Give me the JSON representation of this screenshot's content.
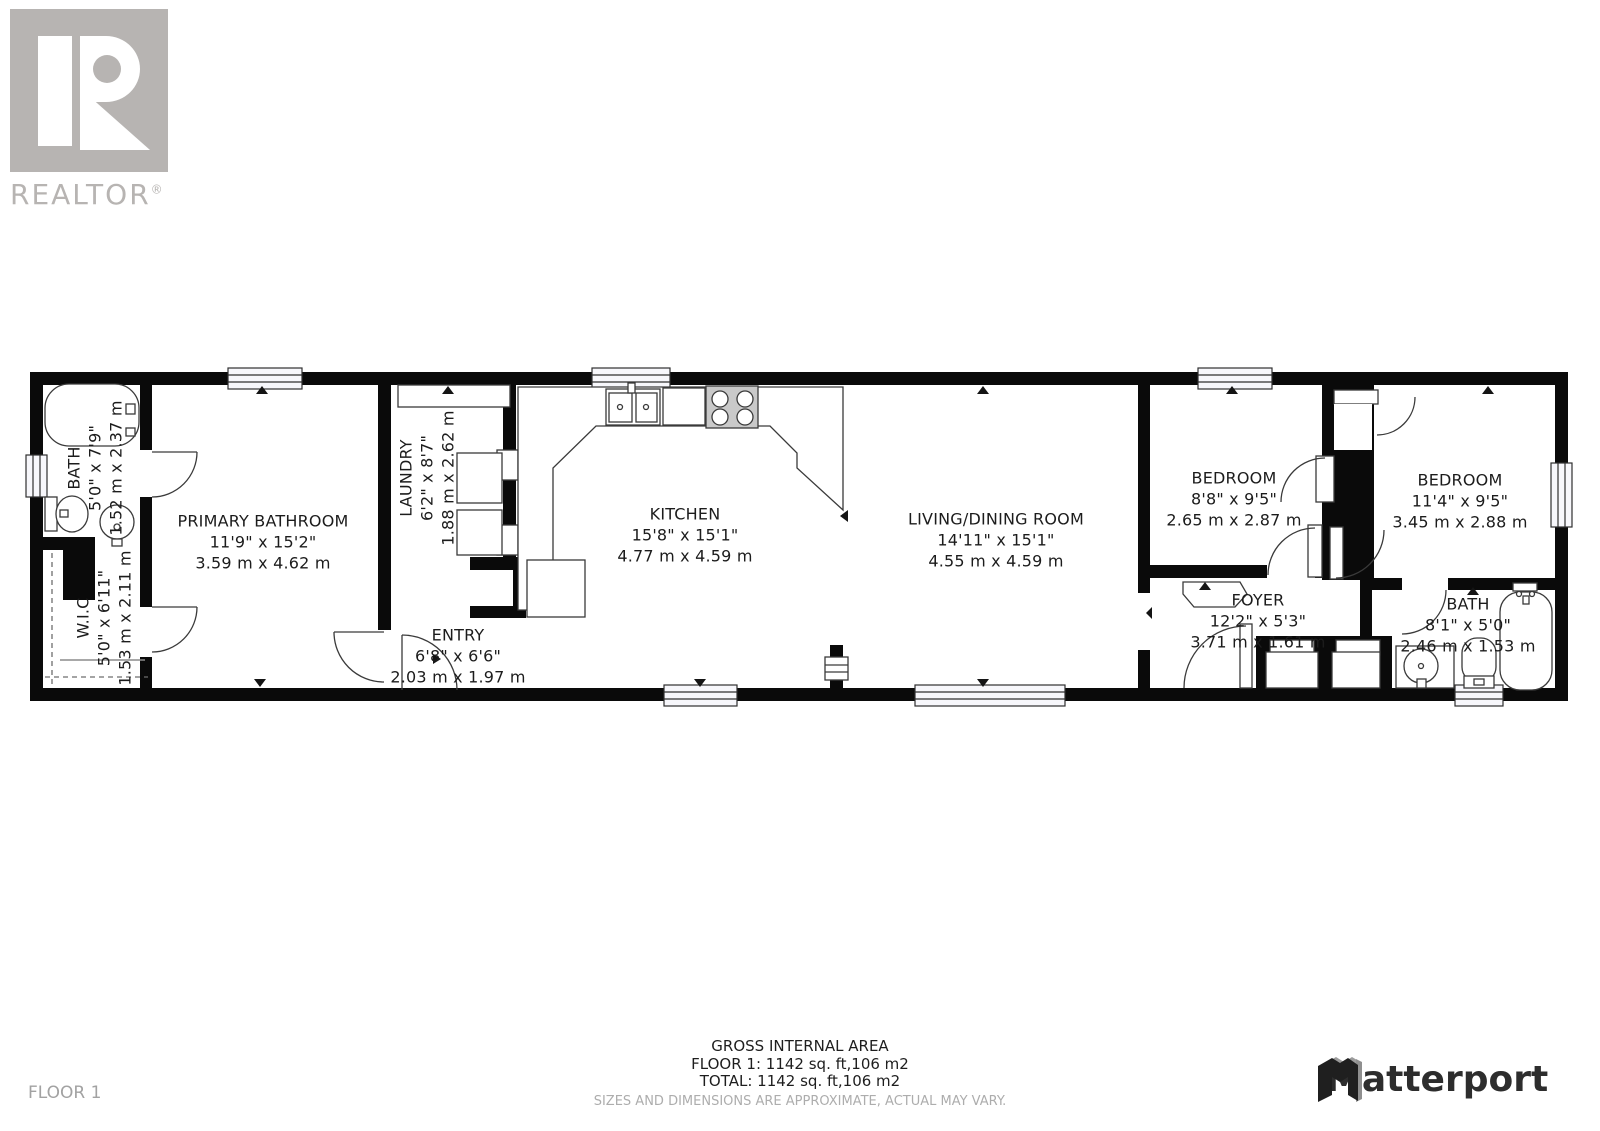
{
  "branding": {
    "realtor_logo_text": "REALTOR",
    "realtor_reg_mark": "®",
    "matterport_logo_text": "Matterport"
  },
  "floor": {
    "label": "FLOOR 1"
  },
  "rooms": {
    "bath1": {
      "name": "BATH",
      "imperial": "5'0\" x 7'9\"",
      "metric": "1.52 m x 2.37 m"
    },
    "wic": {
      "name": "W.I.C",
      "imperial": "5'0\" x 6'11\"",
      "metric": "1.53 m x 2.11 m"
    },
    "primary": {
      "name": "PRIMARY BATHROOM",
      "imperial": "11'9\" x 15'2\"",
      "metric": "3.59 m x 4.62 m"
    },
    "laundry": {
      "name": "LAUNDRY",
      "imperial": "6'2\" x 8'7\"",
      "metric": "1.88 m x 2.62 m"
    },
    "entry": {
      "name": "ENTRY",
      "imperial": "6'8\" x 6'6\"",
      "metric": "2.03 m x 1.97 m"
    },
    "kitchen": {
      "name": "KITCHEN",
      "imperial": "15'8\" x 15'1\"",
      "metric": "4.77 m x 4.59 m"
    },
    "living": {
      "name": "LIVING/DINING ROOM",
      "imperial": "14'11\" x 15'1\"",
      "metric": "4.55 m x 4.59 m"
    },
    "bedroom1": {
      "name": "BEDROOM",
      "imperial": "8'8\" x 9'5\"",
      "metric": "2.65 m x 2.87 m"
    },
    "bedroom2": {
      "name": "BEDROOM",
      "imperial": "11'4\" x 9'5\"",
      "metric": "3.45 m x 2.88 m"
    },
    "foyer": {
      "name": "FOYER",
      "imperial": "12'2\" x 5'3\"",
      "metric": "3.71 m x 1.61 m"
    },
    "bath2": {
      "name": "BATH",
      "imperial": "8'1\" x 5'0\"",
      "metric": "2.46 m x 1.53 m"
    }
  },
  "footer": {
    "gross_title": "GROSS INTERNAL AREA",
    "floor_area": "FLOOR 1: 1142 sq. ft,106 m2",
    "total_area": "TOTAL: 1142 sq. ft,106 m2",
    "disclaimer": "SIZES AND DIMENSIONS ARE APPROXIMATE, ACTUAL MAY VARY."
  },
  "colors": {
    "wall": "#0a0a0a",
    "fixture_stroke": "#3a3a3a",
    "logo_gray": "#b7b4b2",
    "footer_gray": "#adadad",
    "matterport_dark": "#2d2d2d"
  }
}
